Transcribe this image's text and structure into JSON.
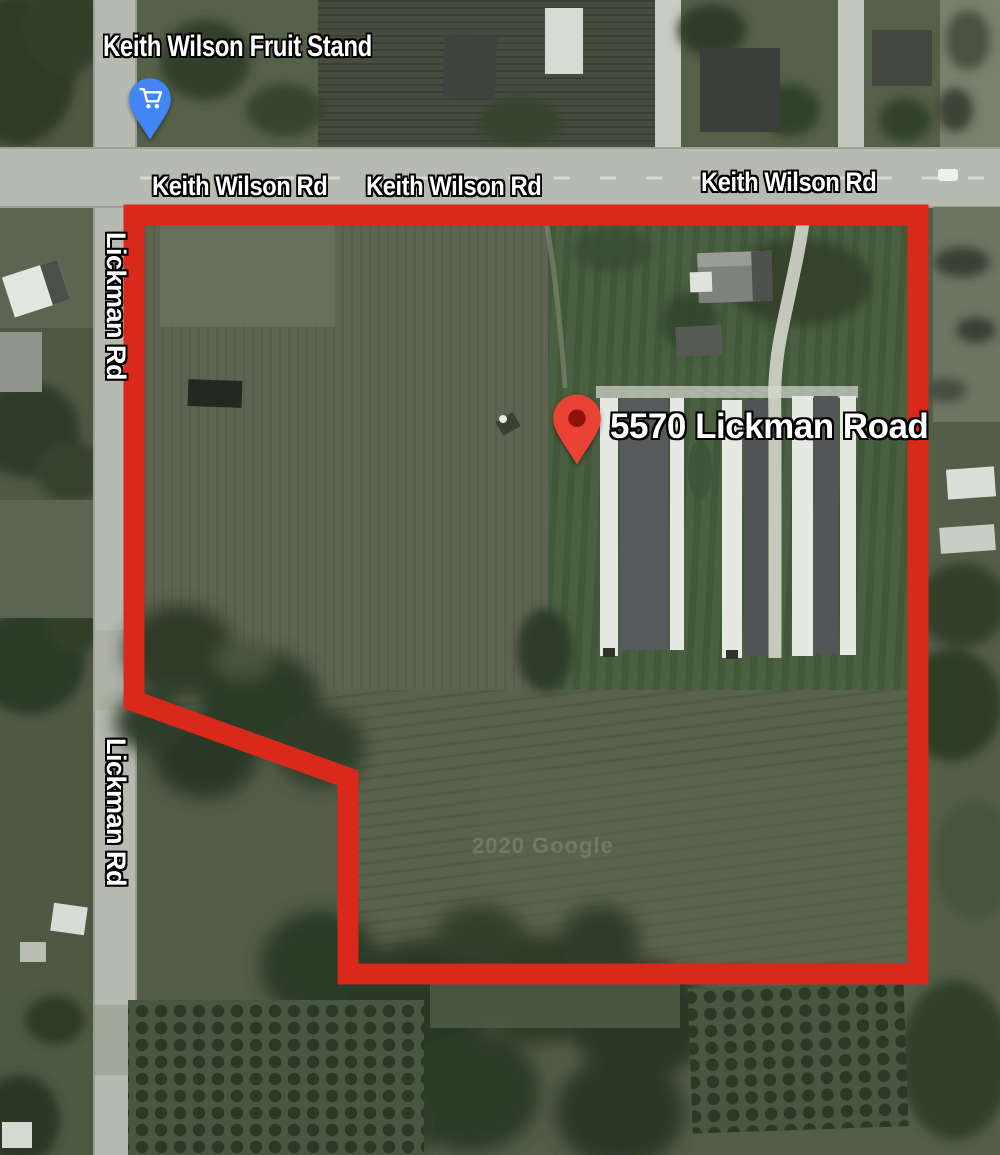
{
  "map": {
    "watermark": "2020 Google",
    "poi": {
      "label": "Keith Wilson Fruit Stand",
      "icon": "shopping-cart-pin"
    },
    "property": {
      "address": "5570 Lickman Road",
      "marker": "red-map-pin",
      "boundary_points": "140,215 918,215 918,974 348,974 348,778 134,701 134,215"
    },
    "road_labels": [
      "Keith Wilson Rd",
      "Keith Wilson Rd",
      "Keith Wilson Rd"
    ],
    "street_labels": [
      "Lickman Rd",
      "Lickman Rd",
      "d"
    ],
    "colors": {
      "boundary": "#d8291a",
      "marker": "#ea4335",
      "marker_inner": "#8e130a",
      "poi_pin": "#4285f4",
      "poi_glyph": "#ffffff",
      "label_text": "#ffffff",
      "label_outline": "#000000",
      "road": "#b7bab0"
    }
  }
}
